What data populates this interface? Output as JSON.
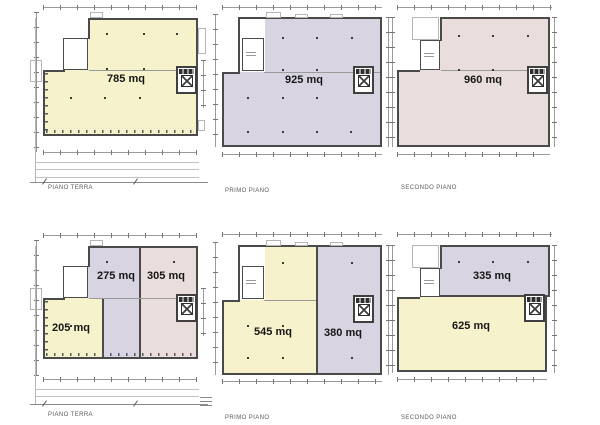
{
  "document_title": "Planimetrie con superfici",
  "colors": {
    "unit_yellow": "#f6f3cc",
    "unit_purple": "#d8d4e1",
    "unit_pink": "#e9dedb",
    "wall": "#4a4a4a"
  },
  "plans": [
    {
      "id": "piano-terra-whole",
      "floor_label": "PIANO TERRA",
      "areas": [
        {
          "label": "785 mq"
        }
      ]
    },
    {
      "id": "primo-piano-whole",
      "floor_label": "PRIMO PIANO",
      "areas": [
        {
          "label": "925 mq"
        }
      ]
    },
    {
      "id": "secondo-piano-whole",
      "floor_label": "SECONDO PIANO",
      "areas": [
        {
          "label": "960 mq"
        }
      ]
    },
    {
      "id": "piano-terra-split",
      "floor_label": "PIANO TERRA",
      "areas": [
        {
          "label": "205 mq"
        },
        {
          "label": "275 mq"
        },
        {
          "label": "305 mq"
        }
      ]
    },
    {
      "id": "primo-piano-split",
      "floor_label": "PRIMO PIANO",
      "areas": [
        {
          "label": "545 mq"
        },
        {
          "label": "380 mq"
        }
      ]
    },
    {
      "id": "secondo-piano-split",
      "floor_label": "SECONDO PIANO",
      "areas": [
        {
          "label": "625 mq"
        },
        {
          "label": "335 mq"
        }
      ]
    }
  ]
}
